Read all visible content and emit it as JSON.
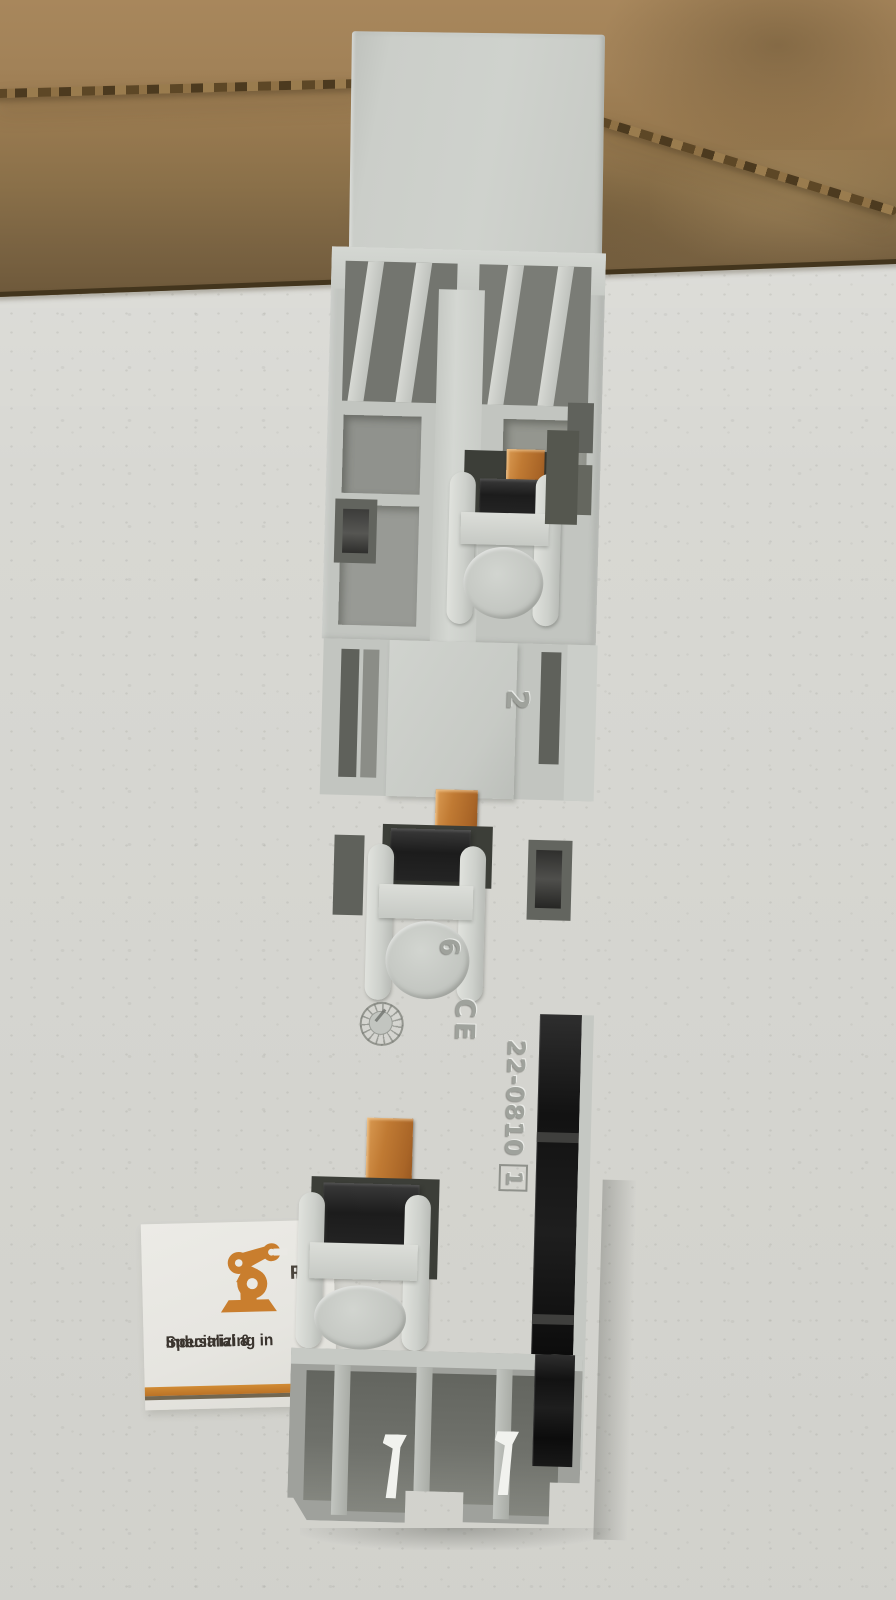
{
  "photo": {
    "subject": "gray DIN-rail terminal module leaning on cardboard box",
    "background": "speckled table surface"
  },
  "module_markings": {
    "slot_number": "2",
    "boss_number": "6",
    "ce_mark": "CE",
    "part_number": "22-0810",
    "mold_cavity": "1"
  },
  "info_card": {
    "logo_icon": "robot-arm-icon",
    "brand_partial_line1": "F",
    "brand_partial_line2": "IN",
    "tagline_line1": "Specializing in",
    "tagline_line2": "Industrial &",
    "accent_color": "#c97e2e"
  },
  "colors": {
    "table": "#d8d8d3",
    "cardboard": "#a28258",
    "cardboard_dark": "#6d583a",
    "module_body": "#c2c5c0",
    "module_highlight": "#d4d7d2",
    "module_shadow": "#8e908b",
    "copper_contact": "#b8732f",
    "clamp_black": "#1e1e1e",
    "card_white": "#eae9e4"
  }
}
